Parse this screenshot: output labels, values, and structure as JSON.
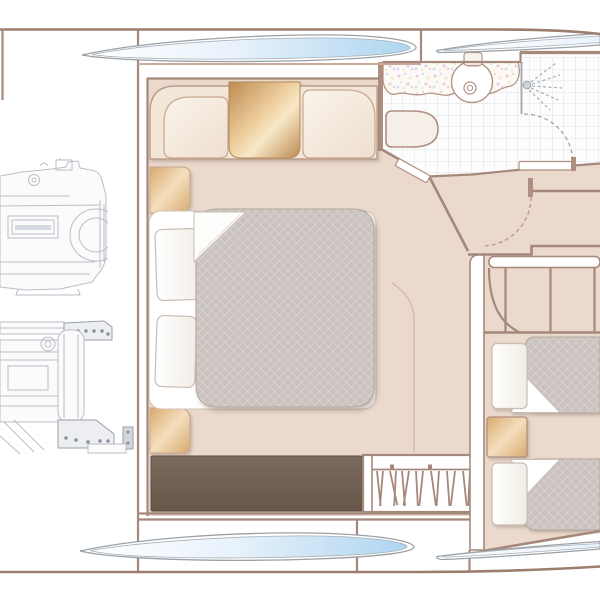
{
  "palette": {
    "hull_line": "#9c7d6e",
    "wall": "#a5887a",
    "wall_light": "#c9a99a",
    "floor": "#ead9cc",
    "cream_band": "#f2e6d9",
    "cream_cushion_hi": "#faf3ea",
    "cream_cushion_lo": "#eedfd0",
    "bronze_dark": "#bd8a50",
    "bronze_mid": "#eecf9e",
    "bronze_hi": "#f8e8c8",
    "bronze_soft_hi": "#f4dfbd",
    "bronze_soft_lo": "#d8a96e",
    "quilt": "#c9c2bf",
    "quilt_line": "#d9d3d0",
    "sofa_hi": "#7a6a5e",
    "sofa_lo": "#675749",
    "pillow_stroke": "#c9bdb4",
    "tile_line": "#dde2e7",
    "glass_edge": "#99a1a7",
    "glass_blue": "#aed5f0",
    "glass_mid": "#e8f2fb",
    "speckle_pink": "#f3c6d6",
    "speckle_blue": "#cfe0f4",
    "speckle_yellow": "#f5ead0",
    "speckle_green": "#d8edd8",
    "speckle_purple": "#e6d6ee",
    "engine_line": "#b9bec6",
    "engine_dark": "#9aa0a8",
    "engine_fill": "#fbfbfc",
    "engine_panel": "#eceef1",
    "white": "#ffffff"
  },
  "structure": {
    "regions": [
      {
        "id": "engine-room",
        "fixtures": [
          "engine-drawing-top",
          "engine-drawing-bottom",
          "wall-mount-pad"
        ]
      },
      {
        "id": "master-cabin",
        "fixtures": [
          "double-bed",
          "pillow-upper",
          "pillow-lower",
          "duvet-folded-corner",
          "headboard-left-cushion",
          "headboard-bronze-panel",
          "headboard-right-cushion",
          "bedside-panel-upper",
          "bedside-panel-lower",
          "foot-of-bed-sofa",
          "hanging-wardrobe",
          "cabin-door-swing"
        ]
      },
      {
        "id": "bathroom",
        "fixtures": [
          "mosaic-vanity-counter",
          "round-wash-basin",
          "faucet",
          "toilet",
          "shower-head",
          "shower-screen",
          "tiled-floor",
          "bathroom-door-swing",
          "bathroom-door-leaf"
        ]
      },
      {
        "id": "stairway",
        "fixtures": [
          "handrail",
          "stair-treads",
          "winder-step"
        ]
      },
      {
        "id": "guest-cabin",
        "fixtures": [
          "berth-upper",
          "berth-lower",
          "pillow-upper",
          "pillow-lower",
          "duvet-folded-corner-upper",
          "duvet-folded-corner-lower",
          "nightstand"
        ]
      },
      {
        "id": "hull",
        "fixtures": [
          "hull-window-top-left",
          "hull-window-top-right",
          "hull-window-bottom-left",
          "hull-window-bottom-right"
        ]
      }
    ]
  }
}
